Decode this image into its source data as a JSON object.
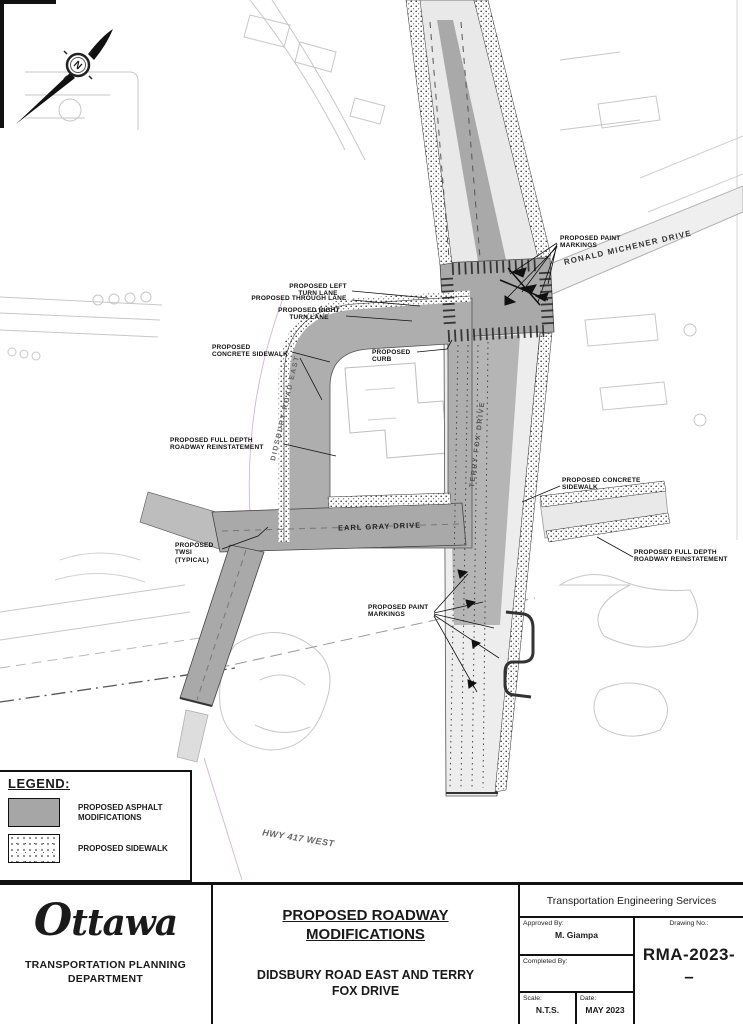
{
  "north_arrow": {
    "letter": "N"
  },
  "streets": {
    "ronald_michener": "RONALD MICHENER DRIVE",
    "didsbury": "DIDSBURY ROAD EAST",
    "terry_fox": "TERRY FOX DRIVE",
    "earl_gray": "EARL GRAY DRIVE",
    "hwy_417": "HWY 417 WEST"
  },
  "callouts": [
    {
      "text": "PROPOSED LEFT TURN LANE"
    },
    {
      "text": "PROPOSED THROUGH LANE"
    },
    {
      "text": "PROPOSED RIGHT TURN LANE"
    },
    {
      "text": "PROPOSED CONCRETE SIDEWALK"
    },
    {
      "text": "PROPOSED CURB"
    },
    {
      "text": "PROPOSED FULL DEPTH ROADWAY REINSTATEMENT"
    },
    {
      "text": "PROPOSED TWSI (TYPICAL)"
    },
    {
      "text": "PROPOSED CONCRETE SIDEWALK"
    },
    {
      "text": "PROPOSED FULL DEPTH ROADWAY REINSTATEMENT"
    },
    {
      "text": "PROPOSED PAINT MARKINGS"
    },
    {
      "text": "PROPOSED PAINT MARKINGS"
    }
  ],
  "legend": {
    "title": "LEGEND:",
    "items": [
      {
        "label": "PROPOSED ASPHALT MODIFICATIONS"
      },
      {
        "label": "PROPOSED SIDEWALK"
      }
    ]
  },
  "title_block": {
    "logo": "ttawa",
    "logo_initial": "O",
    "department": "TRANSPORTATION PLANNING DEPARTMENT",
    "title": "PROPOSED ROADWAY MODIFICATIONS",
    "subtitle": "DIDSBURY ROAD EAST AND TERRY FOX DRIVE",
    "org": "Transportation Engineering Services",
    "approved_label": "Approved  By:",
    "approved_value": "M. Giampa",
    "completed_label": "Completed  By:",
    "drawing_no_label": "Drawing  No.:",
    "drawing_no_value": "RMA-2023-",
    "drawing_no_suffix": "–",
    "scale_label": "Scale:",
    "scale_value": "N.T.S.",
    "date_label": "Date:",
    "date_value": "MAY 2023"
  },
  "colors": {
    "asphalt": "#a9a9a9",
    "existing_linework": "#c7c7c7",
    "ink": "#1a1a1a"
  }
}
